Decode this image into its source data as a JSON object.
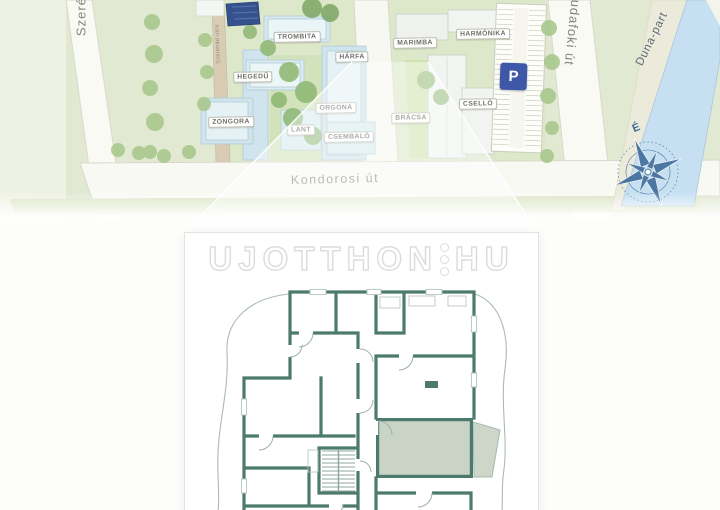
{
  "map": {
    "street_labels": {
      "kondorosi": "Kondorosi út",
      "szeremi": "Szerémi út",
      "budafoki": "Budafoki út",
      "szerenad": "Szerenád utca",
      "duna_part": "Duna-part"
    },
    "building_labels": [
      {
        "text": "TROMBITA",
        "x": 297,
        "y": 37
      },
      {
        "text": "HÁRFA",
        "x": 352,
        "y": 57
      },
      {
        "text": "MARIMBA",
        "x": 415,
        "y": 43
      },
      {
        "text": "HARMÓNIKA",
        "x": 483,
        "y": 34
      },
      {
        "text": "HEGEDŰ",
        "x": 253,
        "y": 77
      },
      {
        "text": "ZONGORA",
        "x": 231,
        "y": 122
      },
      {
        "text": "ORGONA",
        "x": 336,
        "y": 108
      },
      {
        "text": "LANT",
        "x": 301,
        "y": 130
      },
      {
        "text": "CSEMBALÓ",
        "x": 349,
        "y": 137
      },
      {
        "text": "BRÁCSA",
        "x": 411,
        "y": 118
      },
      {
        "text": "CSELLÓ",
        "x": 478,
        "y": 104
      }
    ],
    "parking_sign": "P",
    "compass_north": "É"
  },
  "watermark": {
    "left": "UJOTTHON",
    "right": "HU"
  },
  "colors": {
    "map_green": "#e2e9d3",
    "water_blue": "#c6e0f2",
    "parking_blue": "#3f57a8",
    "wall_teal": "#4c7a6d",
    "highlight_unit": "#c9d3c6",
    "label_text": "#70706a",
    "street_text": "#8b8b80",
    "compass_blue": "#4c77a2"
  }
}
